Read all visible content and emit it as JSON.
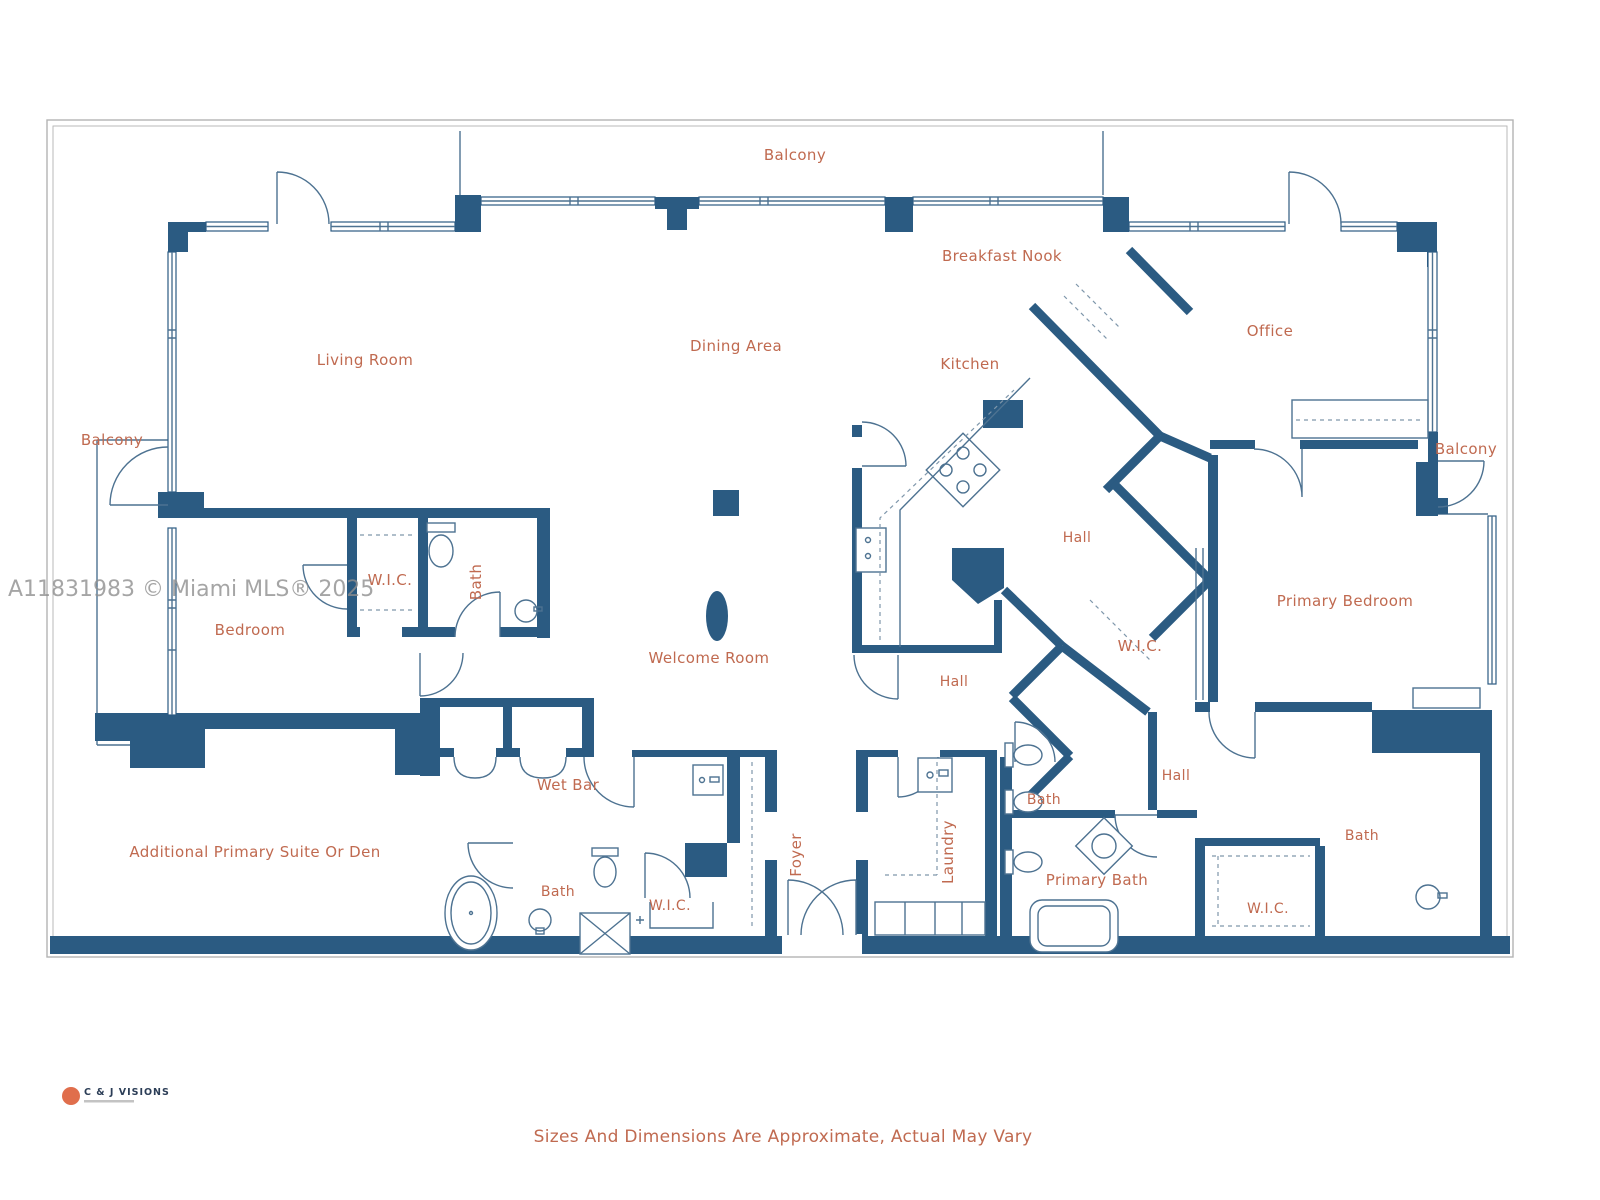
{
  "page": {
    "watermark": "A11831983 © Miami MLS® 2025",
    "disclaimer": "Sizes And Dimensions Are Approximate, Actual May Vary",
    "logo": {
      "name": "C & J VISIONS"
    }
  },
  "colors": {
    "wall": "#2b5b82",
    "fixture_line": "#4d7291",
    "label": "#c06a50",
    "frame": "#b3b3b3",
    "watermark": "#8f8f8f",
    "logo_orange": "#e06e4c",
    "logo_navy": "#2c3e57"
  },
  "rooms": [
    {
      "id": "balcony-top",
      "label": "Balcony"
    },
    {
      "id": "breakfast-nook",
      "label": "Breakfast Nook"
    },
    {
      "id": "office",
      "label": "Office"
    },
    {
      "id": "living-room",
      "label": "Living Room"
    },
    {
      "id": "dining-area",
      "label": "Dining Area"
    },
    {
      "id": "kitchen",
      "label": "Kitchen"
    },
    {
      "id": "balcony-left",
      "label": "Balcony"
    },
    {
      "id": "balcony-right",
      "label": "Balcony"
    },
    {
      "id": "hall-upper",
      "label": "Hall"
    },
    {
      "id": "wic-left",
      "label": "W.I.C."
    },
    {
      "id": "bath-left",
      "label": "Bath"
    },
    {
      "id": "bedroom",
      "label": "Bedroom"
    },
    {
      "id": "primary-bedroom",
      "label": "Primary Bedroom"
    },
    {
      "id": "welcome-room",
      "label": "Welcome Room"
    },
    {
      "id": "wic-mid",
      "label": "W.I.C."
    },
    {
      "id": "hall-center",
      "label": "Hall"
    },
    {
      "id": "hall-lower",
      "label": "Hall"
    },
    {
      "id": "wet-bar",
      "label": "Wet Bar"
    },
    {
      "id": "bath-small",
      "label": "Bath"
    },
    {
      "id": "additional-suite",
      "label": "Additional Primary Suite Or Den"
    },
    {
      "id": "foyer",
      "label": "Foyer"
    },
    {
      "id": "laundry",
      "label": "Laundry"
    },
    {
      "id": "bath-bottom-left",
      "label": "Bath"
    },
    {
      "id": "primary-bath",
      "label": "Primary Bath"
    },
    {
      "id": "bath-right",
      "label": "Bath"
    },
    {
      "id": "wic-bottom",
      "label": "W.I.C."
    },
    {
      "id": "wic-right",
      "label": "W.I.C."
    }
  ]
}
